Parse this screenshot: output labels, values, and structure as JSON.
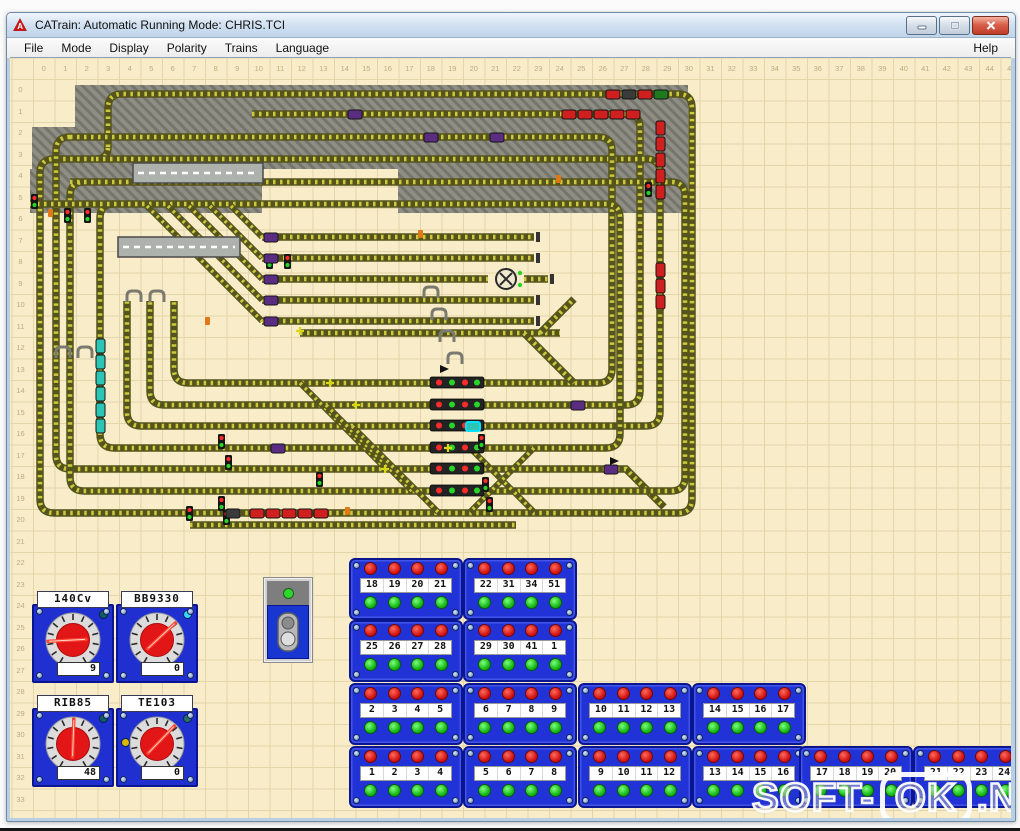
{
  "window": {
    "title": "CATrain: Automatic Running Mode: CHRIS.TCI"
  },
  "menu": {
    "items": [
      "File",
      "Mode",
      "Display",
      "Polarity",
      "Trains",
      "Language"
    ],
    "help": "Help"
  },
  "ruler": {
    "top_start": 0,
    "top_count": 46,
    "left_start": 0,
    "left_count": 35
  },
  "throttles": [
    {
      "name": "140Cv",
      "value": "9"
    },
    {
      "name": "BB9330",
      "value": "0"
    },
    {
      "name": "RIB85",
      "value": "48"
    },
    {
      "name": "TE103",
      "value": "0"
    }
  ],
  "button_panels": {
    "rows": [
      {
        "panels": [
          [
            "18",
            "19",
            "20",
            "21"
          ],
          [
            "22",
            "31",
            "34",
            "51"
          ]
        ]
      },
      {
        "panels": [
          [
            "25",
            "26",
            "27",
            "28"
          ],
          [
            "29",
            "30",
            "41",
            "1"
          ]
        ]
      },
      {
        "panels": [
          [
            "2",
            "3",
            "4",
            "5"
          ],
          [
            "6",
            "7",
            "8",
            "9"
          ],
          [
            "10",
            "11",
            "12",
            "13"
          ],
          [
            "14",
            "15",
            "16",
            "17"
          ]
        ]
      },
      {
        "panels": [
          [
            "1",
            "2",
            "3",
            "4"
          ],
          [
            "5",
            "6",
            "7",
            "8"
          ],
          [
            "9",
            "10",
            "11",
            "12"
          ],
          [
            "13",
            "14",
            "15",
            "16"
          ],
          [
            "17",
            "18",
            "19",
            "20"
          ],
          [
            "21",
            "22",
            "23",
            "24"
          ]
        ]
      }
    ]
  },
  "trains": [
    {
      "color": "mixed",
      "x": 606,
      "y": 89,
      "dir": "h",
      "cars": 4
    },
    {
      "color": "red",
      "x": 562,
      "y": 109,
      "dir": "h",
      "cars": 5
    },
    {
      "color": "red",
      "x": 656,
      "y": 120,
      "dir": "v",
      "cars": 5
    },
    {
      "color": "red",
      "x": 656,
      "y": 262,
      "dir": "v",
      "cars": 3
    },
    {
      "color": "dark",
      "x": 226,
      "y": 508,
      "dir": "h",
      "cars": 1
    },
    {
      "color": "red",
      "x": 250,
      "y": 508,
      "dir": "h",
      "cars": 5
    },
    {
      "color": "teal",
      "x": 96,
      "y": 338,
      "dir": "v",
      "cars": 6
    },
    {
      "color": "teal",
      "x": 466,
      "y": 421,
      "dir": "h",
      "cars": 1,
      "hl": true
    },
    {
      "color": "purple",
      "x": 264,
      "y": 232,
      "dir": "h",
      "cars": 1
    },
    {
      "color": "purple",
      "x": 264,
      "y": 253,
      "dir": "h",
      "cars": 1
    },
    {
      "color": "purple",
      "x": 264,
      "y": 274,
      "dir": "h",
      "cars": 1
    },
    {
      "color": "purple",
      "x": 264,
      "y": 295,
      "dir": "h",
      "cars": 1
    },
    {
      "color": "purple",
      "x": 264,
      "y": 316,
      "dir": "h",
      "cars": 1
    },
    {
      "color": "purple",
      "x": 348,
      "y": 109,
      "dir": "h",
      "cars": 1
    },
    {
      "color": "purple",
      "x": 424,
      "y": 132,
      "dir": "h",
      "cars": 1
    },
    {
      "color": "purple",
      "x": 490,
      "y": 132,
      "dir": "h",
      "cars": 1
    },
    {
      "color": "purple",
      "x": 571,
      "y": 400,
      "dir": "h",
      "cars": 1
    },
    {
      "color": "purple",
      "x": 271,
      "y": 443,
      "dir": "h",
      "cars": 1
    },
    {
      "color": "purple",
      "x": 604,
      "y": 464,
      "dir": "h",
      "cars": 1
    }
  ],
  "signals": [
    {
      "x": 31,
      "y": 193
    },
    {
      "x": 64,
      "y": 207
    },
    {
      "x": 84,
      "y": 207
    },
    {
      "x": 266,
      "y": 253
    },
    {
      "x": 284,
      "y": 253
    },
    {
      "x": 645,
      "y": 181
    },
    {
      "x": 218,
      "y": 433
    },
    {
      "x": 225,
      "y": 454
    },
    {
      "x": 218,
      "y": 495
    },
    {
      "x": 223,
      "y": 509
    },
    {
      "x": 186,
      "y": 505
    },
    {
      "x": 478,
      "y": 433
    },
    {
      "x": 482,
      "y": 476
    },
    {
      "x": 486,
      "y": 496
    },
    {
      "x": 316,
      "y": 471
    }
  ],
  "signal_bars": [
    {
      "x": 430,
      "y": 376
    },
    {
      "x": 430,
      "y": 398
    },
    {
      "x": 430,
      "y": 419
    },
    {
      "x": 430,
      "y": 441
    },
    {
      "x": 430,
      "y": 462
    },
    {
      "x": 430,
      "y": 484
    }
  ],
  "watermark": {
    "prefix": "SOFT-",
    "boxed": "OK",
    "suffix": ".NET"
  },
  "colors": {
    "track": "#54541c",
    "track_tie": "#cdc93e",
    "hatch": "#8e8e84",
    "train_red": "#cf1f1f",
    "train_teal": "#2cc4b4",
    "train_purple": "#5a2d82",
    "train_dark": "#3a3a3a",
    "panel_blue": "#2133d6",
    "light_red": "#d01212",
    "light_green": "#12b412"
  }
}
